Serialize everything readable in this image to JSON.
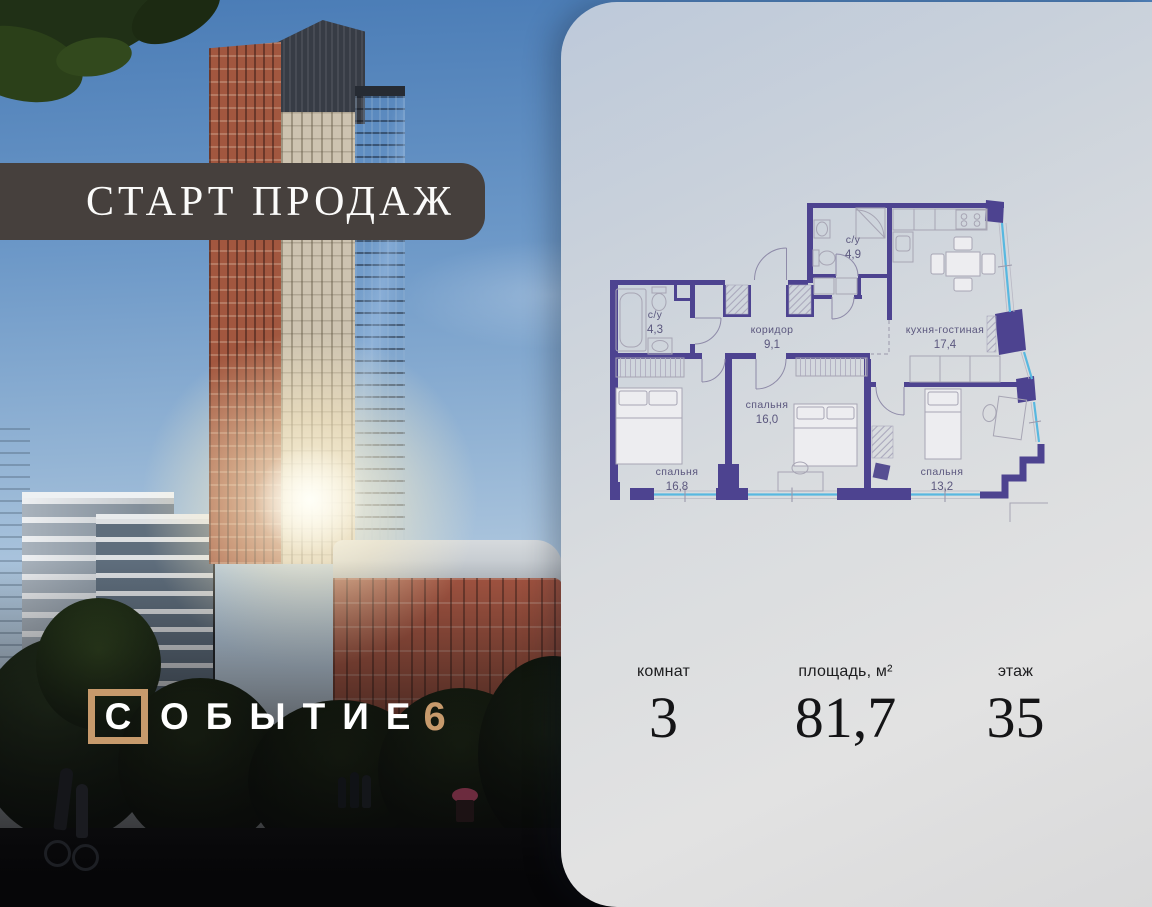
{
  "promo": {
    "banner_text": "СТАРТ ПРОДАЖ"
  },
  "brand": {
    "first_letter": "С",
    "rest_letters": "ОБЫТИЕ",
    "number": "6"
  },
  "floorplan": {
    "rooms": [
      {
        "name": "с/у",
        "area": "4,3"
      },
      {
        "name": "с/у",
        "area": "4,9"
      },
      {
        "name": "коридор",
        "area": "9,1"
      },
      {
        "name": "кухня-гостиная",
        "area": "17,4"
      },
      {
        "name": "спальня",
        "area": "16,0"
      },
      {
        "name": "спальня",
        "area": "16,8"
      },
      {
        "name": "спальня",
        "area": "13,2"
      }
    ]
  },
  "stats": [
    {
      "label": "комнат",
      "value": "3"
    },
    {
      "label": "площадь, м²",
      "value": "81,7"
    },
    {
      "label": "этаж",
      "value": "35"
    }
  ],
  "colors": {
    "wall": "#4d4390",
    "window_glass": "#58b8e0",
    "accent_tan": "#c79a6c",
    "banner_bg": "#46403d"
  }
}
